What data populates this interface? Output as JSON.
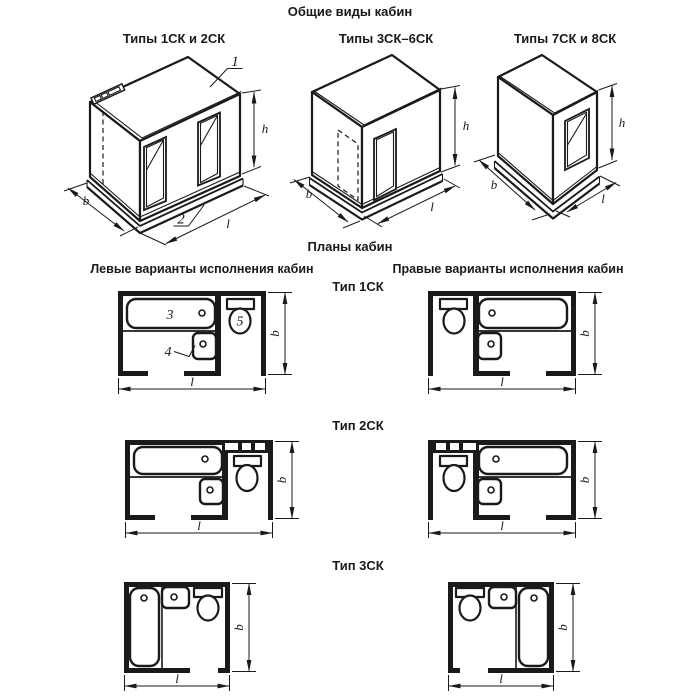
{
  "colors": {
    "ink": "#1a1a1a",
    "background": "#ffffff"
  },
  "titles": {
    "general_views": "Общие виды кабин",
    "plans": "Планы кабин",
    "left_variants": "Левые варианты исполнения кабин",
    "right_variants": "Правые варианты исполнения кабин"
  },
  "general_views": [
    {
      "label": "Типы 1СК и 2СК"
    },
    {
      "label": "Типы 3СК–6СК"
    },
    {
      "label": "Типы 7СК и 8СК"
    }
  ],
  "plan_types": [
    {
      "label": "Тип 1СК"
    },
    {
      "label": "Тип 2СК"
    },
    {
      "label": "Тип 3СК"
    }
  ],
  "dimensions": {
    "width": "b",
    "length": "l",
    "height": "h"
  },
  "callouts": {
    "roof_panel": "1",
    "base_panel": "2",
    "bathtub": "3",
    "washbasin": "4",
    "toilet": "5"
  }
}
